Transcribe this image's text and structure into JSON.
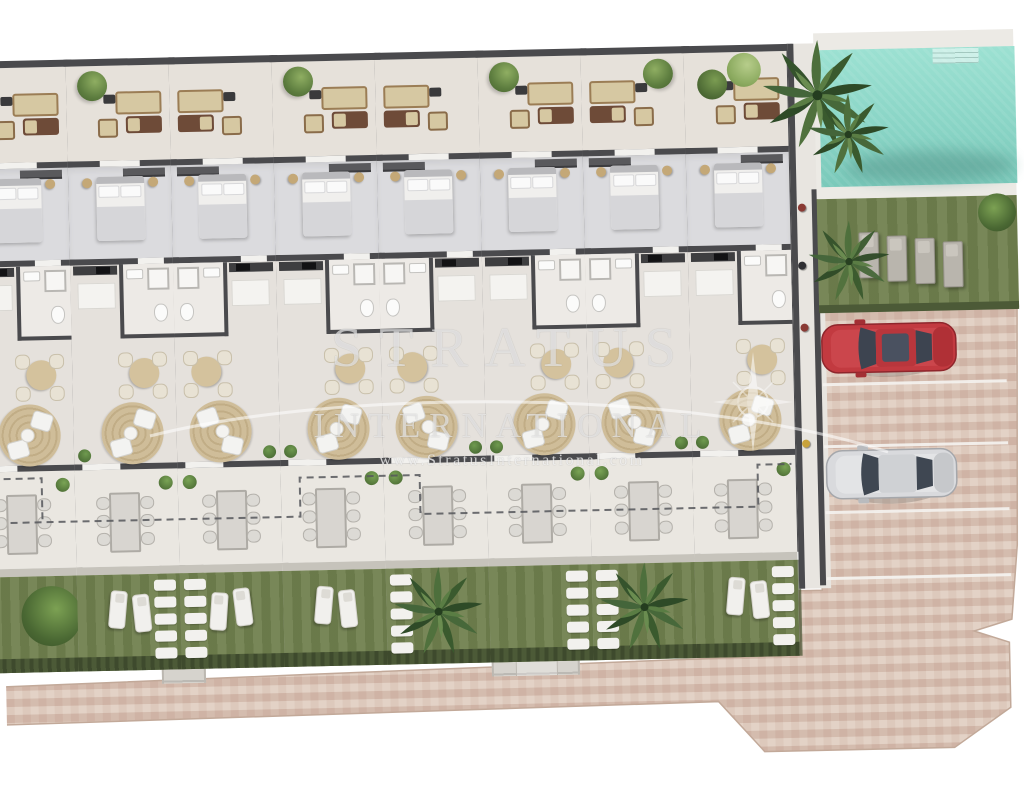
{
  "watermark": {
    "line1": "STRATUS",
    "line2": "INTERNATIONAL",
    "url": "www.StratusInternational.com"
  },
  "palette": {
    "wall": "#4A4A4D",
    "floorRoof": "#E6E1DA",
    "floorBed": "#DBDBDE",
    "floorMain": "#E5E1DC",
    "floorTerr": "#EAE7E1",
    "lawn": "#71814F",
    "hedge": "#4C5A37",
    "pool": "#8BD7C8",
    "paving": "#D9C4B6",
    "rug": "#CDBB97",
    "sofaBeige": "#D6C8A2",
    "sofaBrown": "#6E4B38",
    "carRed": "#C23A40",
    "carWhite": "#D9DADD"
  },
  "units": [
    {
      "flip": true,
      "bush": true
    },
    {
      "flip": true,
      "tree": true,
      "loungers": true,
      "stones": true
    },
    {
      "flip": false,
      "loungers": true,
      "stones": true
    },
    {
      "flip": true,
      "tree": true,
      "loungers": true
    },
    {
      "flip": false,
      "palm": true,
      "stones": true
    },
    {
      "flip": true,
      "tree": true,
      "stones": true
    },
    {
      "flip": false,
      "tree": true,
      "palm": true,
      "stones": true
    },
    {
      "flip": true,
      "tree2": true,
      "loungers": true,
      "stones": true
    }
  ],
  "amenities": {
    "units_count": 8,
    "pool": 1,
    "communal_sun_loungers": 4,
    "parking_spaces": 4,
    "cars": [
      {
        "name": "red-car",
        "color": "#C23A40"
      },
      {
        "name": "white-car",
        "color": "#D9DADD"
      }
    ],
    "entry_paths": 2
  }
}
